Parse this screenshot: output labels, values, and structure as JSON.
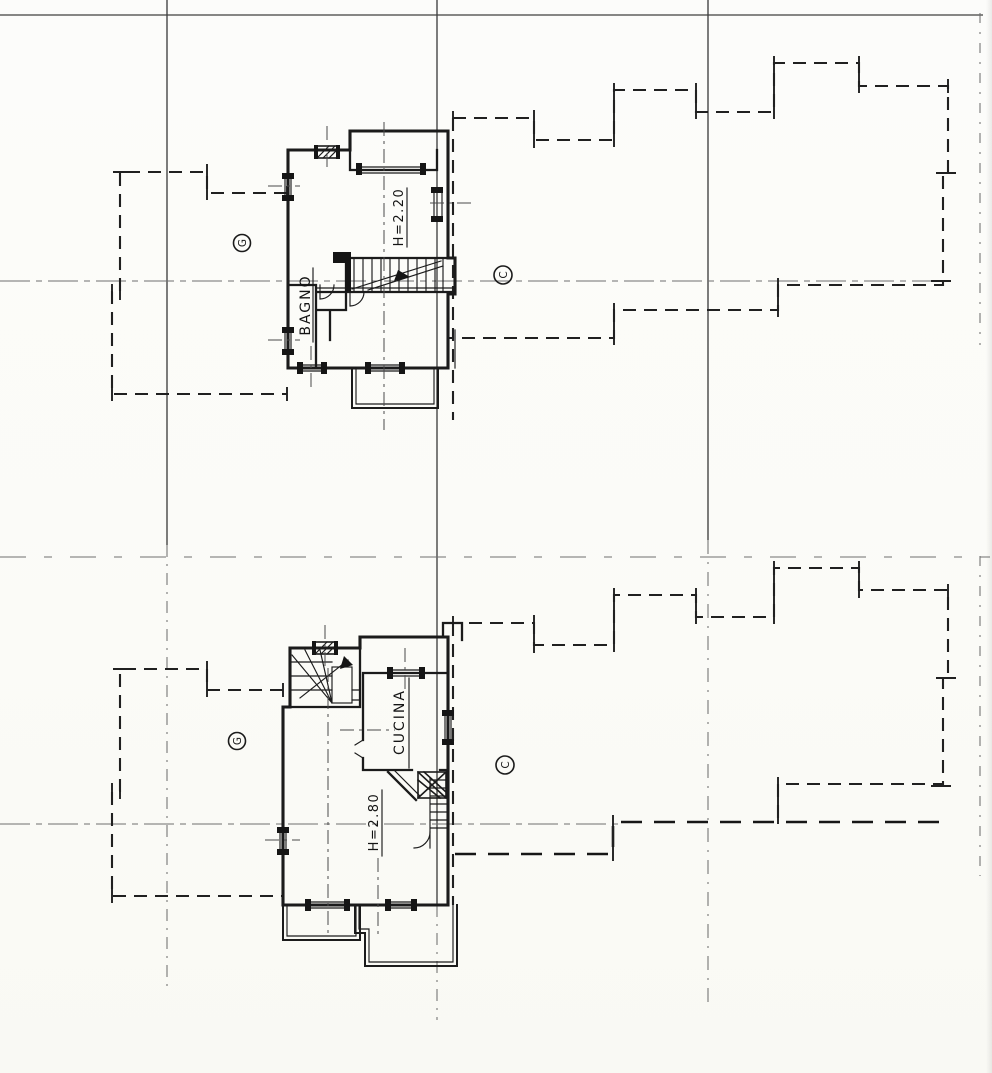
{
  "drawing": {
    "upper_plan": {
      "height_label": "H=2.20",
      "room_label": "BAGNO",
      "grid_letter_left": "G",
      "grid_letter_right": "C"
    },
    "lower_plan": {
      "height_label": "H=2.80",
      "room_label": "CUCINA",
      "grid_letter_left": "G",
      "grid_letter_right": "C"
    },
    "colors": {
      "paper": "#fbfbf8",
      "ink": "#1b1b1b",
      "faint_line": "#6f6f6f"
    }
  }
}
